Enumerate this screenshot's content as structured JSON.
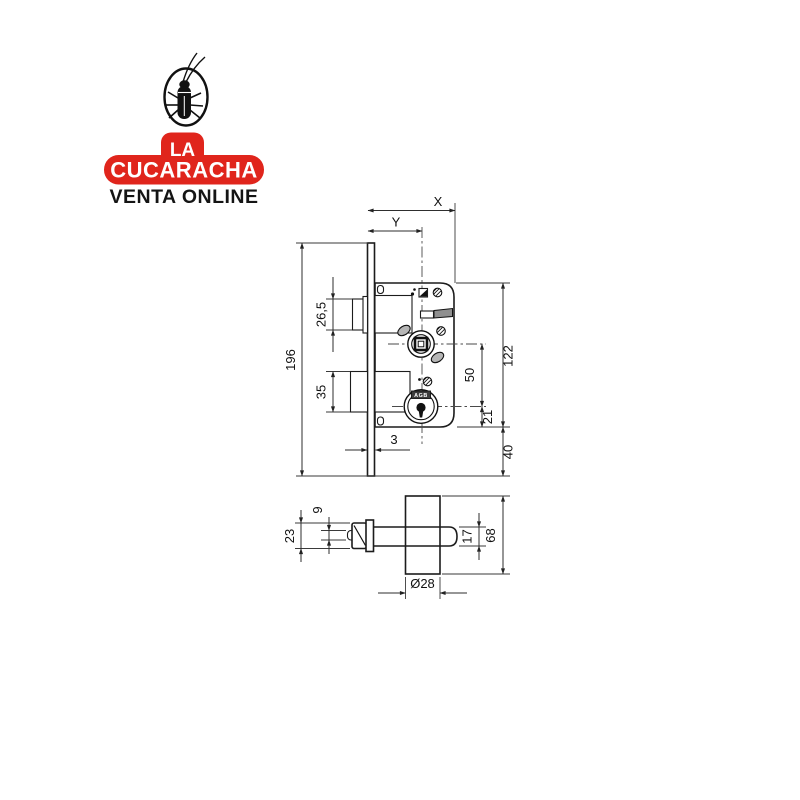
{
  "logo": {
    "top_text": "LA",
    "name": "CUCARACHA",
    "subtitle": "VENTA ONLINE",
    "brand_red": "#e0251c"
  },
  "drawing": {
    "cylinder_brand": "AGB",
    "dims": {
      "x": "X",
      "y": "Y",
      "faceplate_height": "196",
      "latch_height": "26,5",
      "deadbolt_height": "35",
      "faceplate_thickness": "3",
      "case_height": "122",
      "axis_distance": "50",
      "cylinder_to_edge": "21",
      "bottom_margin": "40",
      "latch_head": "23",
      "latch_nose": "9",
      "shaft_height": "17",
      "section_height": "68",
      "knob_diameter": "Ø28"
    }
  }
}
